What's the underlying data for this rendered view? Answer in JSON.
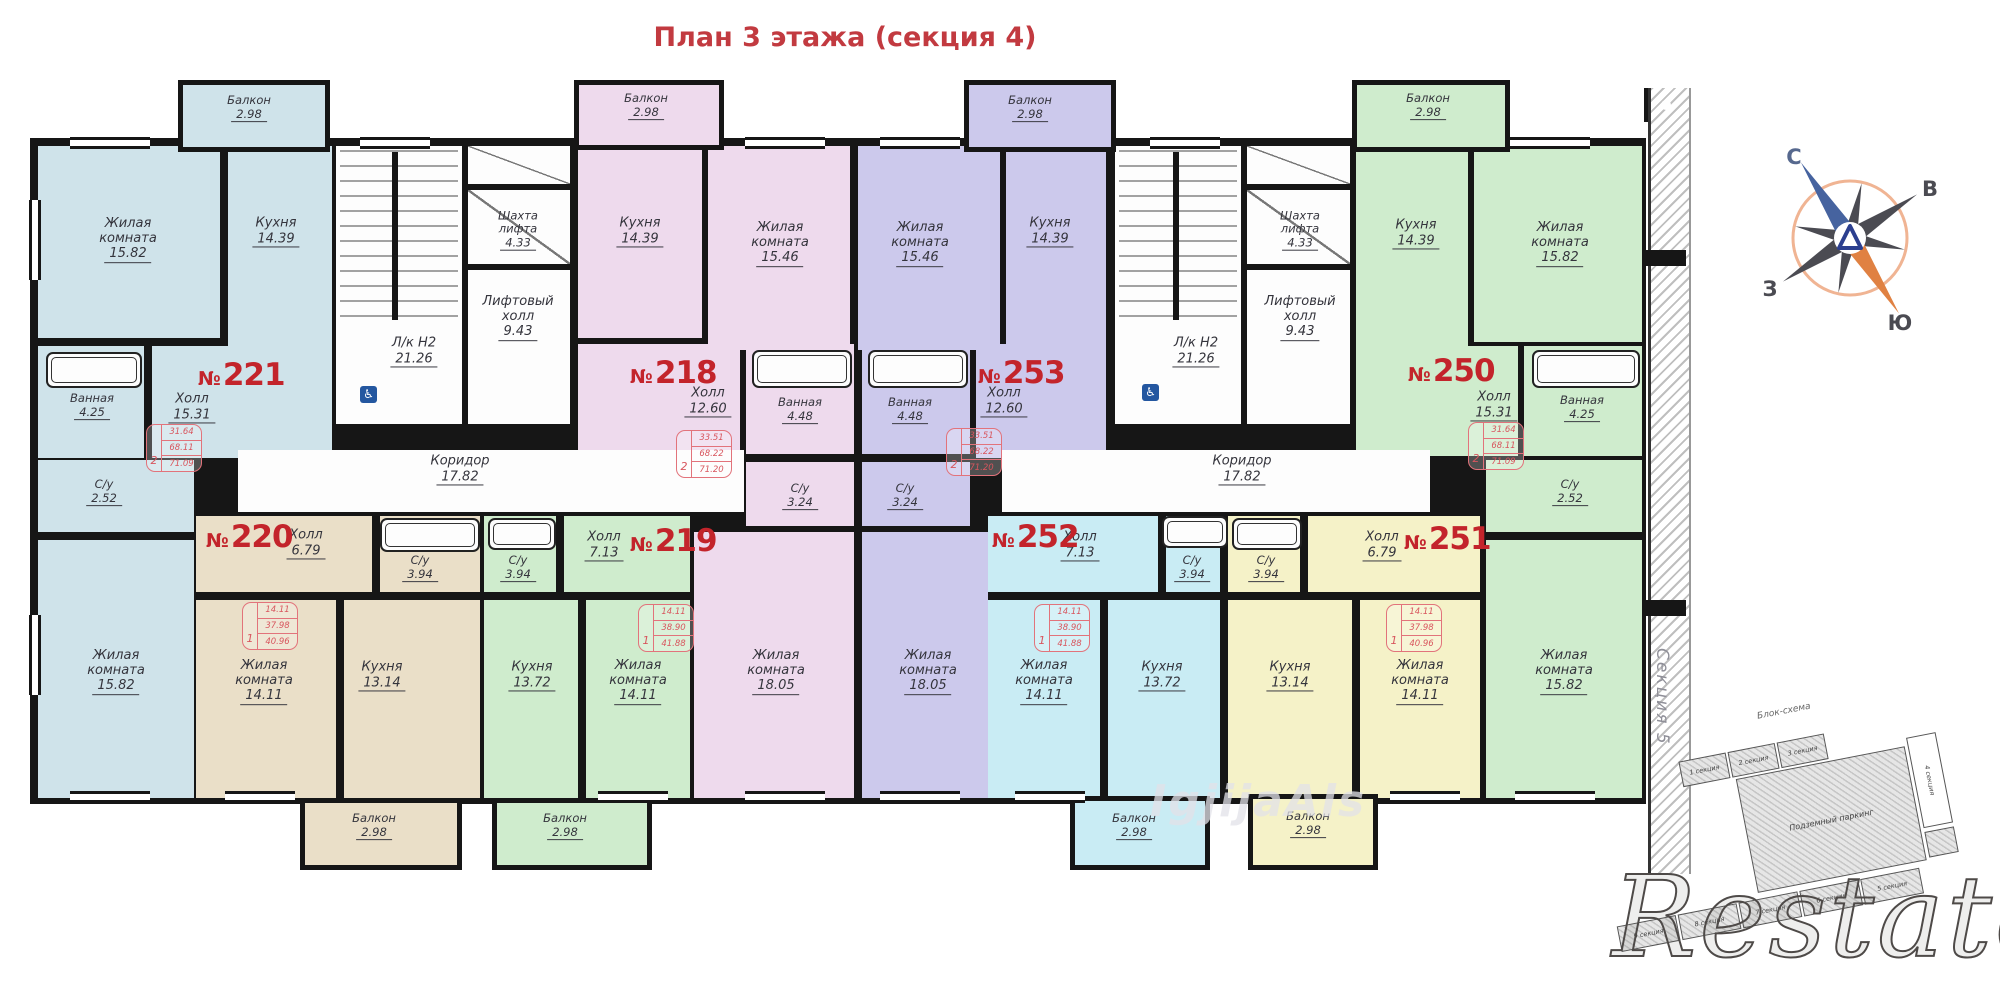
{
  "title": "План 3 этажа (секция 4)",
  "watermark": {
    "brand": "Restate",
    "faint": "IgjijaAls"
  },
  "side_section": "Секция 5",
  "compass": {
    "n": "С",
    "e": "В",
    "w": "З",
    "s": "Ю"
  },
  "schema": {
    "title": "Блок-схема",
    "parking": "Подземный паркинг",
    "top": [
      "1 секция",
      "2 секция",
      "3 секция"
    ],
    "right": "4 секция",
    "bottom": [
      "9 секция",
      "8 секция",
      "7 секция",
      "6 секция",
      "5 секция"
    ]
  },
  "nums": {
    "n221": {
      "p": "№",
      "v": "221"
    },
    "n218": {
      "p": "№",
      "v": "218"
    },
    "n253": {
      "p": "№",
      "v": "253"
    },
    "n250": {
      "p": "№",
      "v": "250"
    },
    "n220": {
      "p": "№",
      "v": "220"
    },
    "n219": {
      "p": "№",
      "v": "219"
    },
    "n252": {
      "p": "№",
      "v": "252"
    },
    "n251": {
      "p": "№",
      "v": "251"
    }
  },
  "specs": {
    "s221": {
      "n": "2",
      "v1": "31.64",
      "v2": "68.11",
      "v3": "71.09"
    },
    "s218": {
      "n": "2",
      "v1": "33.51",
      "v2": "68.22",
      "v3": "71.20"
    },
    "s253": {
      "n": "2",
      "v1": "33.51",
      "v2": "68.22",
      "v3": "71.20"
    },
    "s250": {
      "n": "2",
      "v1": "31.64",
      "v2": "68.11",
      "v3": "71.09"
    },
    "s220": {
      "n": "1",
      "v1": "14.11",
      "v2": "37.98",
      "v3": "40.96"
    },
    "s219": {
      "n": "1",
      "v1": "14.11",
      "v2": "38.90",
      "v3": "41.88"
    },
    "s252": {
      "n": "1",
      "v1": "14.11",
      "v2": "38.90",
      "v3": "41.88"
    },
    "s251": {
      "n": "1",
      "v1": "14.11",
      "v2": "37.98",
      "v3": "40.96"
    }
  },
  "labels": {
    "bal221": {
      "t": "Балкон",
      "a": "2.98"
    },
    "r221_1": {
      "t": "Жилая\nкомната",
      "a": "15.82"
    },
    "k221": {
      "t": "Кухня",
      "a": "14.39"
    },
    "hall221": {
      "t": "Холл",
      "a": "15.31"
    },
    "bath221": {
      "t": "Ванная",
      "a": "4.25"
    },
    "wc221": {
      "t": "С/у",
      "a": "2.52"
    },
    "r221_2": {
      "t": "Жилая\nкомната",
      "a": "15.82"
    },
    "stairL": {
      "t": "Л/к Н2",
      "a": "21.26"
    },
    "shaftL": {
      "t": "Шахта\nлифта",
      "a": "4.33"
    },
    "liftL": {
      "t": "Лифтовый\nхолл",
      "a": "9.43"
    },
    "corrL": {
      "t": "Коридор",
      "a": "17.82"
    },
    "bal218": {
      "t": "Балкон",
      "a": "2.98"
    },
    "k218": {
      "t": "Кухня",
      "a": "14.39"
    },
    "r218_1": {
      "t": "Жилая\nкомната",
      "a": "15.46"
    },
    "hall218": {
      "t": "Холл",
      "a": "12.60"
    },
    "bath218": {
      "t": "Ванная",
      "a": "4.48"
    },
    "wc218": {
      "t": "С/у",
      "a": "3.24"
    },
    "r218_2": {
      "t": "Жилая\nкомната",
      "a": "18.05"
    },
    "bal253": {
      "t": "Балкон",
      "a": "2.98"
    },
    "r253_1": {
      "t": "Жилая\nкомната",
      "a": "15.46"
    },
    "k253": {
      "t": "Кухня",
      "a": "14.39"
    },
    "hall253": {
      "t": "Холл",
      "a": "12.60"
    },
    "bath253": {
      "t": "Ванная",
      "a": "4.48"
    },
    "wc253": {
      "t": "С/у",
      "a": "3.24"
    },
    "r253_2": {
      "t": "Жилая\nкомната",
      "a": "18.05"
    },
    "stairR": {
      "t": "Л/к Н2",
      "a": "21.26"
    },
    "shaftR": {
      "t": "Шахта\nлифта",
      "a": "4.33"
    },
    "liftR": {
      "t": "Лифтовый\nхолл",
      "a": "9.43"
    },
    "corrR": {
      "t": "Коридор",
      "a": "17.82"
    },
    "bal250": {
      "t": "Балкон",
      "a": "2.98"
    },
    "k250": {
      "t": "Кухня",
      "a": "14.39"
    },
    "r250_1": {
      "t": "Жилая\nкомната",
      "a": "15.82"
    },
    "hall250": {
      "t": "Холл",
      "a": "15.31"
    },
    "bath250": {
      "t": "Ванная",
      "a": "4.25"
    },
    "wc250": {
      "t": "С/у",
      "a": "2.52"
    },
    "r250_2": {
      "t": "Жилая\nкомната",
      "a": "15.82"
    },
    "bal220": {
      "t": "Балкон",
      "a": "2.98"
    },
    "hall220": {
      "t": "Холл",
      "a": "6.79"
    },
    "wc220": {
      "t": "С/у",
      "a": "3.94"
    },
    "r220": {
      "t": "Жилая\nкомната",
      "a": "14.11"
    },
    "k220": {
      "t": "Кухня",
      "a": "13.14"
    },
    "bal219": {
      "t": "Балкон",
      "a": "2.98"
    },
    "hall219": {
      "t": "Холл",
      "a": "7.13"
    },
    "wc219": {
      "t": "С/у",
      "a": "3.94"
    },
    "r219": {
      "t": "Жилая\nкомната",
      "a": "14.11"
    },
    "k219": {
      "t": "Кухня",
      "a": "13.72"
    },
    "bal252": {
      "t": "Балкон",
      "a": "2.98"
    },
    "hall252": {
      "t": "Холл",
      "a": "7.13"
    },
    "wc252": {
      "t": "С/у",
      "a": "3.94"
    },
    "r252": {
      "t": "Жилая\nкомната",
      "a": "14.11"
    },
    "k252": {
      "t": "Кухня",
      "a": "13.72"
    },
    "bal251": {
      "t": "Балкон",
      "a": "2.98"
    },
    "hall251": {
      "t": "Холл",
      "a": "6.79"
    },
    "wc251": {
      "t": "С/у",
      "a": "3.94"
    },
    "r251": {
      "t": "Жилая\nкомната",
      "a": "14.11"
    },
    "k251": {
      "t": "Кухня",
      "a": "13.14"
    }
  }
}
